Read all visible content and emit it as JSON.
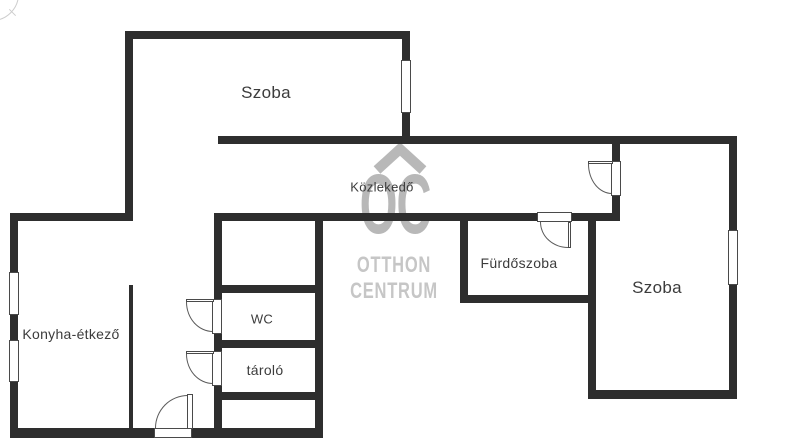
{
  "title": "Otthon Centrum floor plan",
  "colors": {
    "wall": "#2e2e2e",
    "label_text": "#3c3c3c",
    "opening_outline": "#4a4a4a",
    "door_arc": "#5a5a5a",
    "watermark_glyph": "#b8b8b8",
    "watermark_text": "#c6c6c6",
    "compass": "#cdcdcd",
    "background": "#ffffff"
  },
  "watermark": {
    "icon": "roof-chevron-icon",
    "monogram": "OC",
    "brand_top": "OTTHON",
    "brand_bottom": "CENTRUM"
  },
  "rooms": [
    {
      "id": "szoba-top",
      "label": "Szoba",
      "cx": 266,
      "cy": 93,
      "size": 17
    },
    {
      "id": "kozlekedo",
      "label": "Közlekedő",
      "cx": 382,
      "cy": 187,
      "size": 13
    },
    {
      "id": "furdoszoba",
      "label": "Fürdőszoba",
      "cx": 519,
      "cy": 263,
      "size": 14
    },
    {
      "id": "szoba-right",
      "label": "Szoba",
      "cx": 657,
      "cy": 288,
      "size": 17
    },
    {
      "id": "konyha-etkezo",
      "label": "Konyha-étkező",
      "cx": 71,
      "cy": 334,
      "size": 14
    },
    {
      "id": "wc",
      "label": "WC",
      "cx": 262,
      "cy": 319,
      "size": 13
    },
    {
      "id": "tarolo",
      "label": "tároló",
      "cx": 265,
      "cy": 370,
      "size": 14
    }
  ],
  "geometry": {
    "walls": [
      {
        "id": "top-room-top",
        "r": [
          125,
          31,
          285,
          8
        ]
      },
      {
        "id": "top-room-left",
        "r": [
          125,
          31,
          8,
          190
        ]
      },
      {
        "id": "top-room-right",
        "r": [
          402,
          39,
          8,
          105
        ]
      },
      {
        "id": "corridor-top",
        "r": [
          218,
          136,
          519,
          8
        ]
      },
      {
        "id": "right-outer",
        "r": [
          729,
          136,
          8,
          263
        ]
      },
      {
        "id": "kitchen-top",
        "r": [
          10,
          213,
          123,
          8
        ]
      },
      {
        "id": "kitchen-left-outer",
        "r": [
          10,
          213,
          8,
          225
        ]
      },
      {
        "id": "corridor-bottom",
        "r": [
          214,
          213,
          406,
          8
        ]
      },
      {
        "id": "kitchen-partition",
        "r": [
          129,
          285,
          4,
          145
        ]
      },
      {
        "id": "core-left",
        "r": [
          214,
          213,
          8,
          225
        ]
      },
      {
        "id": "core-right",
        "r": [
          315,
          213,
          8,
          225
        ]
      },
      {
        "id": "core-divider-1",
        "r": [
          214,
          285,
          109,
          8
        ]
      },
      {
        "id": "core-divider-2",
        "r": [
          214,
          340,
          109,
          8
        ]
      },
      {
        "id": "core-divider-3",
        "r": [
          214,
          392,
          109,
          8
        ]
      },
      {
        "id": "bottom-outer",
        "r": [
          10,
          428,
          313,
          10
        ]
      },
      {
        "id": "bathroom-left",
        "r": [
          460,
          213,
          8,
          88
        ]
      },
      {
        "id": "bathroom-bottom",
        "r": [
          460,
          295,
          136,
          8
        ]
      },
      {
        "id": "bathroom-right",
        "r": [
          588,
          213,
          8,
          186
        ]
      },
      {
        "id": "corridor-right-stub",
        "r": [
          612,
          136,
          8,
          85
        ]
      },
      {
        "id": "right-room-bottom",
        "r": [
          588,
          390,
          149,
          9
        ]
      }
    ],
    "windows": [
      {
        "id": "top-room-window",
        "r": [
          401,
          60,
          10,
          53
        ]
      },
      {
        "id": "right-room-window",
        "r": [
          728,
          230,
          10,
          55
        ]
      },
      {
        "id": "kitchen-window-1",
        "r": [
          9,
          272,
          10,
          43
        ]
      },
      {
        "id": "kitchen-window-2",
        "r": [
          9,
          340,
          10,
          42
        ]
      }
    ],
    "doors": [
      {
        "id": "corridor-to-room",
        "opening": [
          611,
          161,
          10,
          35
        ],
        "leaf": [
          588,
          161,
          25,
          3
        ],
        "arc": {
          "r": [
            588,
            164,
            24,
            30
          ],
          "corner": "bl"
        }
      },
      {
        "id": "bathroom",
        "opening": [
          537,
          212,
          35,
          10
        ],
        "leaf": [
          568,
          222,
          3,
          26
        ],
        "arc": {
          "r": [
            540,
            222,
            28,
            26
          ],
          "corner": "bl"
        }
      },
      {
        "id": "wc",
        "opening": [
          212,
          299,
          10,
          35
        ],
        "leaf": [
          186,
          299,
          28,
          3
        ],
        "arc": {
          "r": [
            186,
            302,
            27,
            30
          ],
          "corner": "bl"
        }
      },
      {
        "id": "tarolo",
        "opening": [
          212,
          351,
          10,
          35
        ],
        "leaf": [
          186,
          351,
          28,
          3
        ],
        "arc": {
          "r": [
            186,
            354,
            27,
            30
          ],
          "corner": "bl"
        }
      },
      {
        "id": "entrance",
        "opening": [
          154,
          428,
          38,
          10
        ],
        "leaf": [
          187,
          394,
          6,
          35
        ],
        "arc": {
          "r": [
            155,
            395,
            33,
            33
          ],
          "corner": "tl"
        }
      }
    ]
  }
}
